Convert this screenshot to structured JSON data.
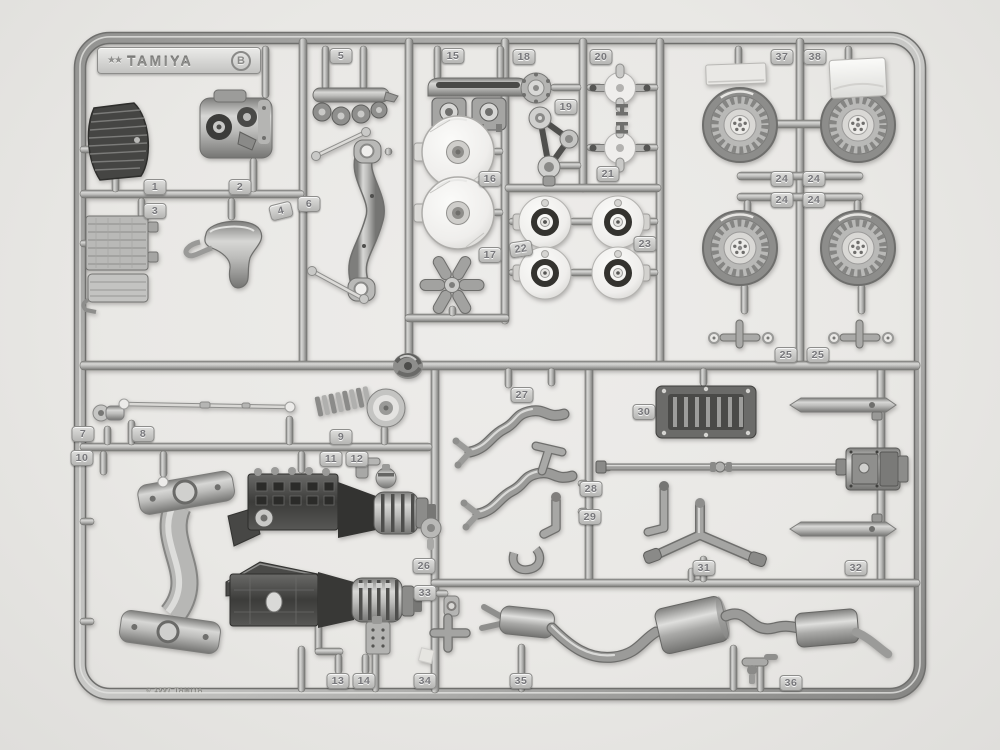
{
  "scene": {
    "subject": "silver plastic model kit parts sprue photographed on a light background",
    "colors": {
      "background": "#e9e8e5",
      "sprue_base": "#a9a9a7",
      "sprue_highlight": "#d9d9d7",
      "sprue_shadow": "#6f6f6d",
      "part_white": "#efeeec",
      "part_dark": "#3f3f3d",
      "tag_face": "#c9c9c7",
      "tag_text": "#77777b"
    }
  },
  "logo": {
    "brand": "TAMIYA",
    "sprue_letter": "B",
    "mark_glyph": "★★"
  },
  "copyright_text": "© 1997 TAMIYA",
  "tags": [
    "1",
    "2",
    "3",
    "4",
    "5",
    "6",
    "7",
    "8",
    "9",
    "10",
    "11",
    "12",
    "13",
    "14",
    "15",
    "16",
    "17",
    "18",
    "19",
    "20",
    "21",
    "22",
    "23",
    "24",
    "24",
    "24",
    "24",
    "25",
    "25",
    "26",
    "27",
    "28",
    "29",
    "30",
    "31",
    "32",
    "33",
    "34",
    "35",
    "36",
    "37",
    "38"
  ]
}
